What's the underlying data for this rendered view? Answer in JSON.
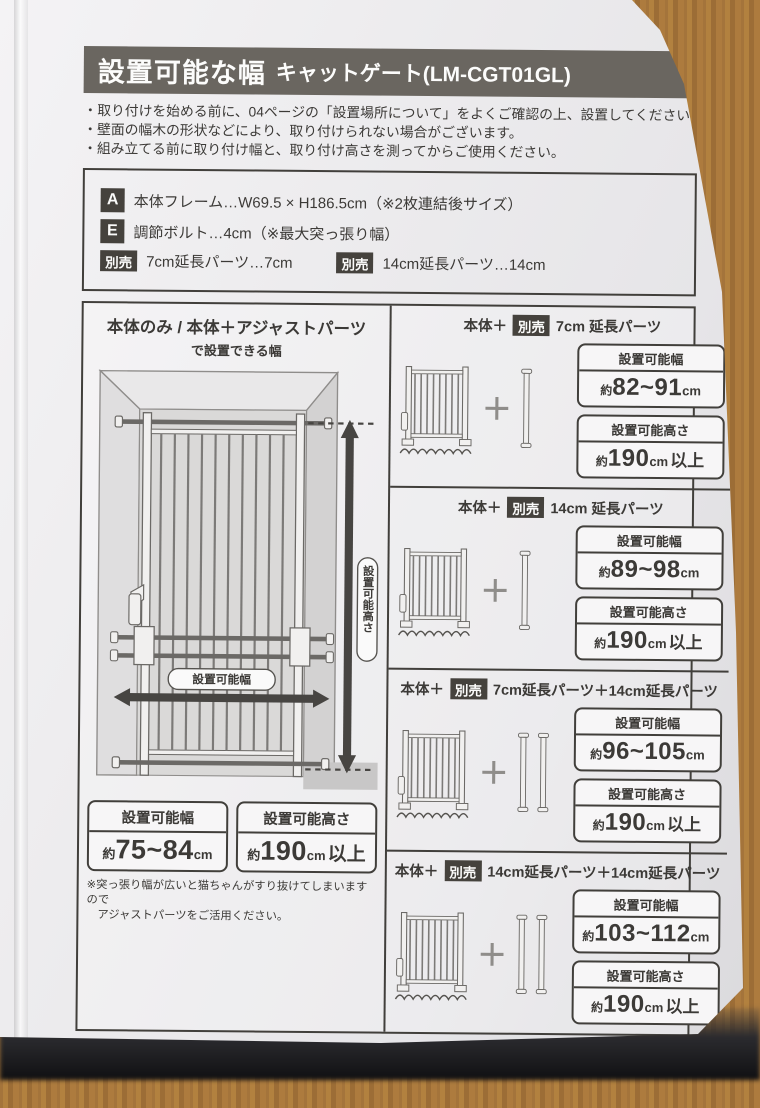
{
  "colors": {
    "header_bar": "#6a6660",
    "badge": "#45423d",
    "ink": "#3c3a37",
    "paper": "#ecebed",
    "wood": "#a9783d"
  },
  "header": {
    "title": "設置可能な幅",
    "model": "キャットゲート(LM-CGT01GL)"
  },
  "intro_notes": [
    "・取り付けを始める前に、04ページの「設置場所について」をよくご確認の上、設置してください。",
    "・壁面の幅木の形状などにより、取り付けられない場合がございます。",
    "・組み立てる前に取り付け幅と、取り付け高さを測ってからご使用ください。"
  ],
  "spec_box": {
    "rows": [
      {
        "badge": "A",
        "text": "本体フレーム…W69.5 × H186.5cm（※2枚連結後サイズ）"
      },
      {
        "badge": "E",
        "text": "調節ボルト…4cm（※最大突っ張り幅）"
      }
    ],
    "optional": [
      {
        "badge": "別売",
        "text": "7cm延長パーツ…7cm"
      },
      {
        "badge": "別売",
        "text": "14cm延長パーツ…14cm"
      }
    ]
  },
  "main_panel": {
    "title": "本体のみ / 本体＋アジャストパーツ",
    "subtitle": "で設置できる幅",
    "diagram_labels": {
      "width": "設置可能幅",
      "height": "設置可能高さ"
    },
    "width_box": {
      "label": "設置可能幅",
      "approx": "約",
      "value": "75~84",
      "unit": "cm"
    },
    "height_box": {
      "label": "設置可能高さ",
      "approx": "約",
      "value": "190",
      "unit": "cm",
      "suffix": "以上"
    },
    "footnote_line1": "※突っ張り幅が広いと猫ちゃんがすり抜けてしまいますので",
    "footnote_line2": "アジャストパーツをご活用ください。"
  },
  "combo_panels": [
    {
      "prefix": "本体＋",
      "badge": "別売",
      "name": "7cm 延長パーツ",
      "plus": "＋",
      "width_box": {
        "label": "設置可能幅",
        "approx": "約",
        "value": "82~91",
        "unit": "cm"
      },
      "height_box": {
        "label": "設置可能高さ",
        "approx": "約",
        "value": "190",
        "unit": "cm",
        "suffix": "以上"
      }
    },
    {
      "prefix": "本体＋",
      "badge": "別売",
      "name": "14cm 延長パーツ",
      "plus": "＋",
      "width_box": {
        "label": "設置可能幅",
        "approx": "約",
        "value": "89~98",
        "unit": "cm"
      },
      "height_box": {
        "label": "設置可能高さ",
        "approx": "約",
        "value": "190",
        "unit": "cm",
        "suffix": "以上"
      }
    },
    {
      "prefix": "本体＋",
      "badge": "別売",
      "name": "7cm延長パーツ＋14cm延長パーツ",
      "plus": "＋",
      "width_box": {
        "label": "設置可能幅",
        "approx": "約",
        "value": "96~105",
        "unit": "cm"
      },
      "height_box": {
        "label": "設置可能高さ",
        "approx": "約",
        "value": "190",
        "unit": "cm",
        "suffix": "以上"
      }
    },
    {
      "prefix": "本体＋",
      "badge": "別売",
      "name": "14cm延長パーツ＋14cm延長パーツ",
      "plus": "＋",
      "width_box": {
        "label": "設置可能幅",
        "approx": "約",
        "value": "103~112",
        "unit": "cm"
      },
      "height_box": {
        "label": "設置可能高さ",
        "approx": "約",
        "value": "190",
        "unit": "cm",
        "suffix": "以上"
      }
    }
  ],
  "bottom_note": "※設置する場所や取り付け方法によって、上記のサイズに対応できない場合がございます。",
  "page_number": "-05-"
}
